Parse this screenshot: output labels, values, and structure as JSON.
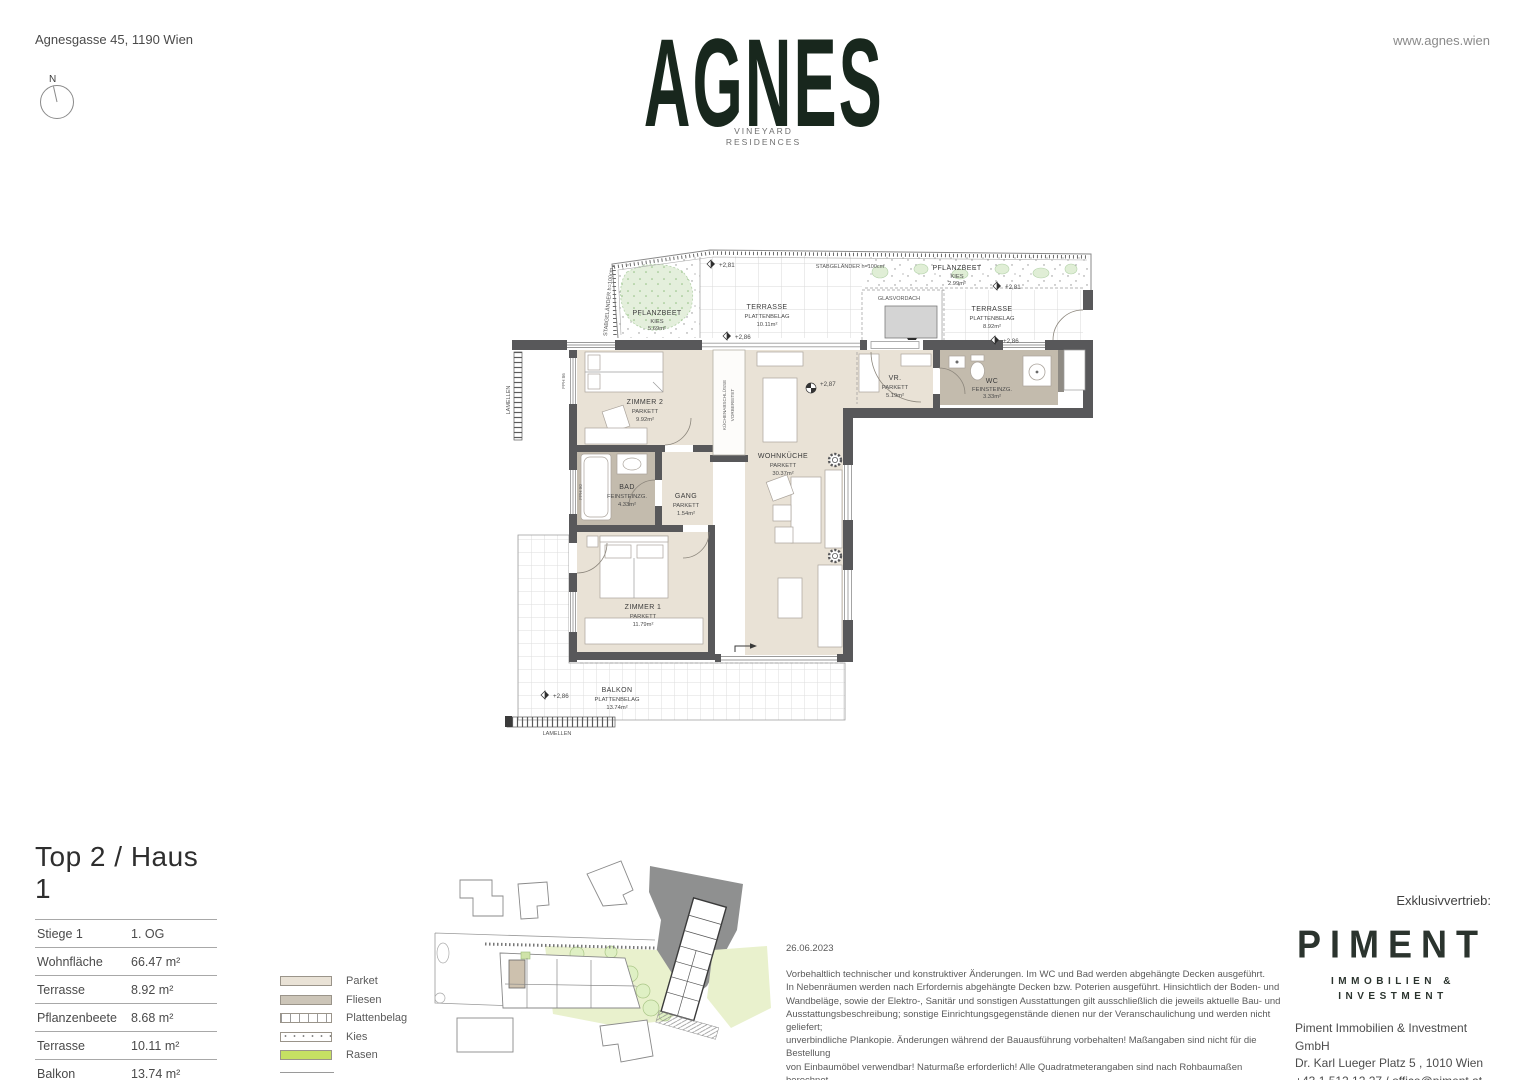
{
  "header": {
    "address": "Agnesgasse 45, 1190 Wien",
    "website": "www.agnes.wien",
    "compass": "N"
  },
  "logo": {
    "title": "AGNES",
    "subtitle1": "VINEYARD",
    "subtitle2": "RESIDENCES"
  },
  "floorplan": {
    "rooms": {
      "zimmer2": {
        "name": "ZIMMER 2",
        "floor": "PARKETT",
        "area": "9.92m²"
      },
      "bad": {
        "name": "BAD",
        "floor": "FEINSTEINZG.",
        "area": "4.33m²"
      },
      "gang": {
        "name": "GANG",
        "floor": "PARKETT",
        "area": "1.54m²"
      },
      "zimmer1": {
        "name": "ZIMMER 1",
        "floor": "PARKETT",
        "area": "11.79m²"
      },
      "wohnkueche": {
        "name": "WOHNKÜCHE",
        "floor": "PARKETT",
        "area": "30.37m²"
      },
      "vr": {
        "name": "VR.",
        "floor": "PARKETT",
        "area": "5.19m²"
      },
      "wc": {
        "name": "WC",
        "floor": "FEINSTEINZG.",
        "area": "3.33m²"
      }
    },
    "outdoor": {
      "pflanzbeet_left": {
        "name": "PFLANZBEET",
        "floor": "KIES",
        "area": "5.69m²"
      },
      "terrasse_left": {
        "name": "TERRASSE",
        "floor": "PLATTENBELAG",
        "area": "10.11m²"
      },
      "pflanzbeet_right": {
        "name": "PFLANZBEET",
        "floor": "KIES",
        "area": "2.99m²"
      },
      "terrasse_right": {
        "name": "TERRASSE",
        "floor": "PLATTENBELAG",
        "area": "8.92m²"
      },
      "balkon": {
        "name": "BALKON",
        "floor": "PLATTENBELAG",
        "area": "13.74m²"
      }
    },
    "labels": {
      "stabgelaender": "STABGELÄNDER h=100cm",
      "glasvordach": "GLASVORDACH",
      "kueche1": "KÜCHENABSCHLÜSSE",
      "kueche2": "VORBEREITET",
      "lamellen": "LAMELLEN",
      "fph86": "FPH 86",
      "fph90": "FPH 90"
    },
    "levels": {
      "l281": "+2,81",
      "l286": "+2,86",
      "l287": "+2,87"
    }
  },
  "unit_info": {
    "title": "Top 2 / Haus 1",
    "rows": [
      {
        "label": "Stiege 1",
        "value": "1. OG"
      },
      {
        "label": "Wohnfläche",
        "value": "66.47 m²"
      },
      {
        "label": "Terrasse",
        "value": "8.92 m²"
      },
      {
        "label": "Pflanzenbeete",
        "value": "8.68 m²"
      },
      {
        "label": "Terrasse",
        "value": "10.11 m²"
      },
      {
        "label": "Balkon",
        "value": "13.74 m²"
      }
    ]
  },
  "legend": {
    "items": [
      {
        "label": "Parket"
      },
      {
        "label": "Fliesen"
      },
      {
        "label": "Plattenbelag"
      },
      {
        "label": "Kies"
      },
      {
        "label": "Rasen"
      }
    ]
  },
  "disclaimer": {
    "date": "26.06.2023",
    "lines": [
      "Vorbehaltlich technischer und konstruktiver Änderungen. Im WC und Bad werden abgehängte Decken ausgeführt.",
      "In Nebenräumen werden nach Erfordernis abgehängte Decken bzw. Poterien ausgeführt. Hinsichtlich der Boden- und",
      "Wandbeläge, sowie der Elektro-, Sanitär und sonstigen Ausstattungen gilt ausschließlich die jeweils aktuelle Bau- und",
      "Ausstattungsbeschreibung; sonstige Einrichtungsgegenstände dienen nur der Veranschaulichung und werden nicht geliefert;",
      "unverbindliche Plankopie. Änderungen während der Bauausführung vorbehalten! Maßangaben sind nicht für die Bestellung",
      "von Einbaumöbel verwendbar! Naturmaße erforderlich! Alle Quadratmeterangaben sind nach Rohbaumaßen berechnet.",
      "Die dargestellten Sanitärgegenstände und Heizkörper sind als Symbol zu verstehen. Änderungen bezüglich Größe und",
      "Lage behalten wir uns vor."
    ]
  },
  "distributor": {
    "label": "Exklusivvertrieb:",
    "brand": "PIMENT",
    "tagline1": "IMMOBILIEN &",
    "tagline2": "INVESTMENT",
    "company": "Piment Immobilien & Investment GmbH",
    "address": "Dr. Karl Lueger Platz 5 , 1010 Wien",
    "contact": "+43 1 512 12 27 / office@piment.at"
  },
  "colors": {
    "brand_green": "#18271d",
    "parket": "#e9e2d6",
    "feinsteinzeug": "#c3bbad",
    "wall": "#58585a",
    "rasen": "#c6e063"
  }
}
